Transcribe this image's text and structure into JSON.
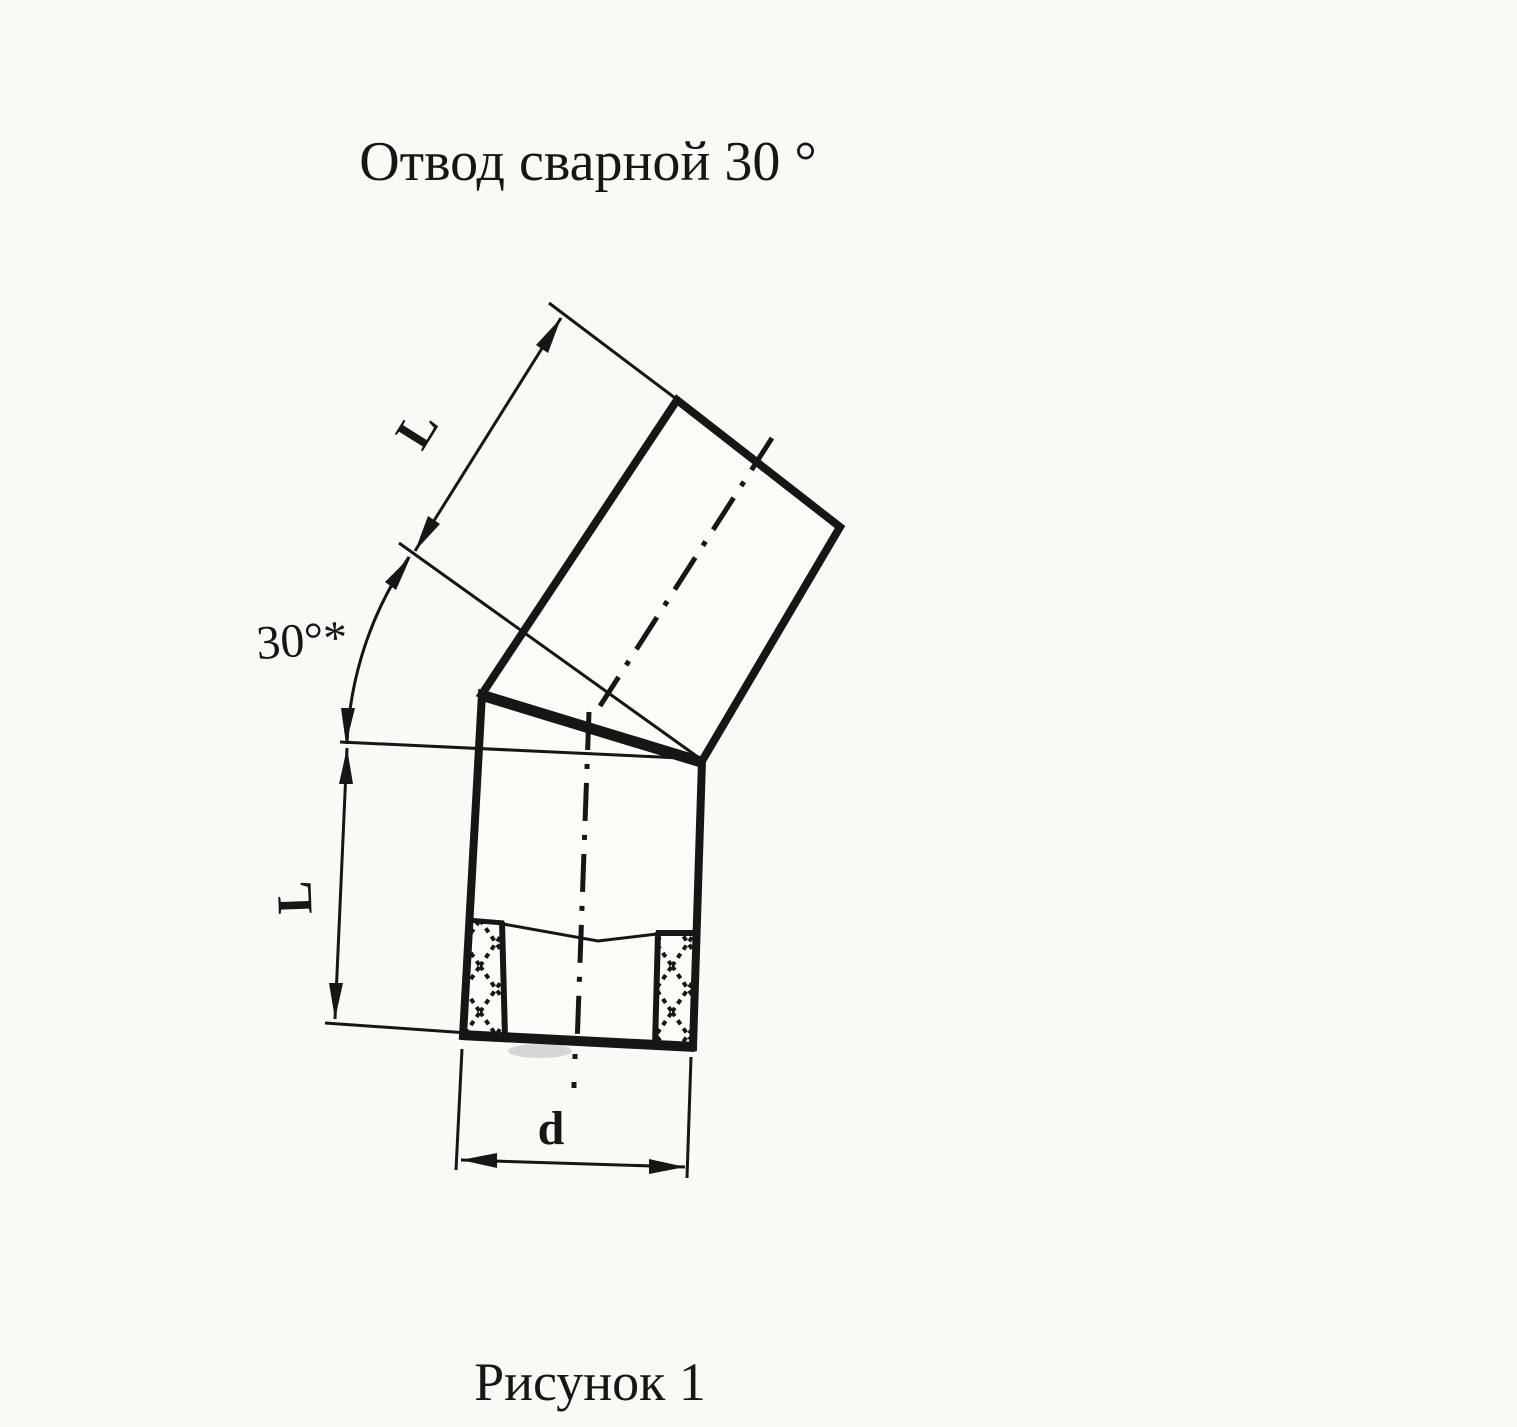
{
  "title": "Отвод сварной 30 °",
  "caption": "Рисунок 1",
  "drawing": {
    "upper_segment_length_label": "L",
    "lower_segment_length_label": "L",
    "angle_label": "30°*",
    "diameter_label": "d",
    "angle_value_deg": 30,
    "description": "welded pipe elbow, two segments joined by weld seam"
  },
  "colors": {
    "ink": "#161616",
    "paper": "#f9f9f6"
  }
}
